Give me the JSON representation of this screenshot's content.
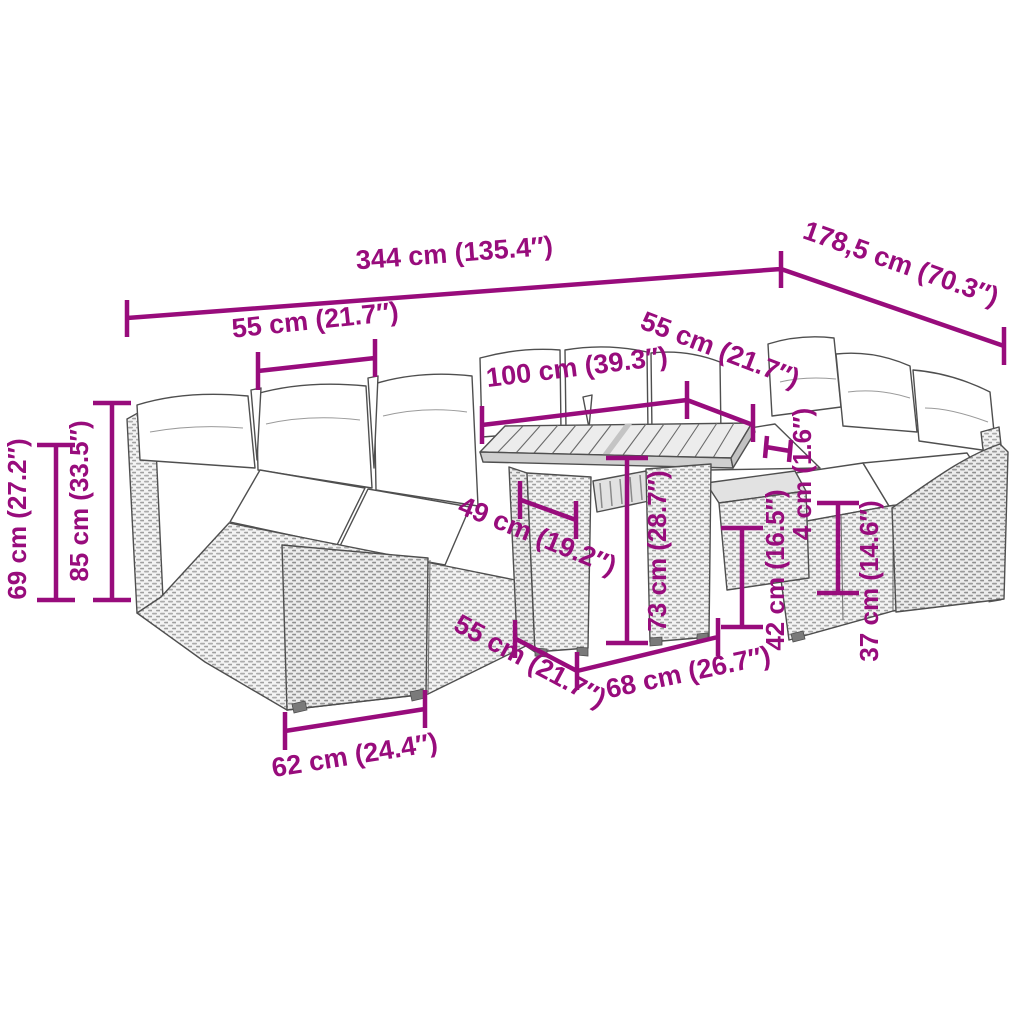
{
  "product": "Garden lounge set with table - dimension diagram",
  "colors": {
    "accent": "#980C7C",
    "outline": "#4f4f4f",
    "cushion": "#ffffff",
    "rattan_light": "#f3f3f3",
    "rattan_dark": "#ababab"
  },
  "dims": {
    "total_width": "344 cm (135.4″)",
    "total_depth": "178,5 cm (70.3″)",
    "seat_width_left": "55 cm (21.7″)",
    "table_length": "100 cm (39.3″)",
    "seat_width_right": "55 cm (21.7″)",
    "seat_depth": "49 cm (19.2″)",
    "table_height": "73 cm (28.7″)",
    "seat_height": "42 cm (16.5″)",
    "table_sofa_gap": "4 cm (1.6″)",
    "base_height": "37 cm (14.6″)",
    "backrest_height": "69 cm (27.2″)",
    "total_height": "85 cm (33.5″)",
    "end_module_width": "62 cm (24.4″)",
    "end_module_depth": "55 cm (21.7″)",
    "table_width": "68 cm (26.7″)"
  }
}
